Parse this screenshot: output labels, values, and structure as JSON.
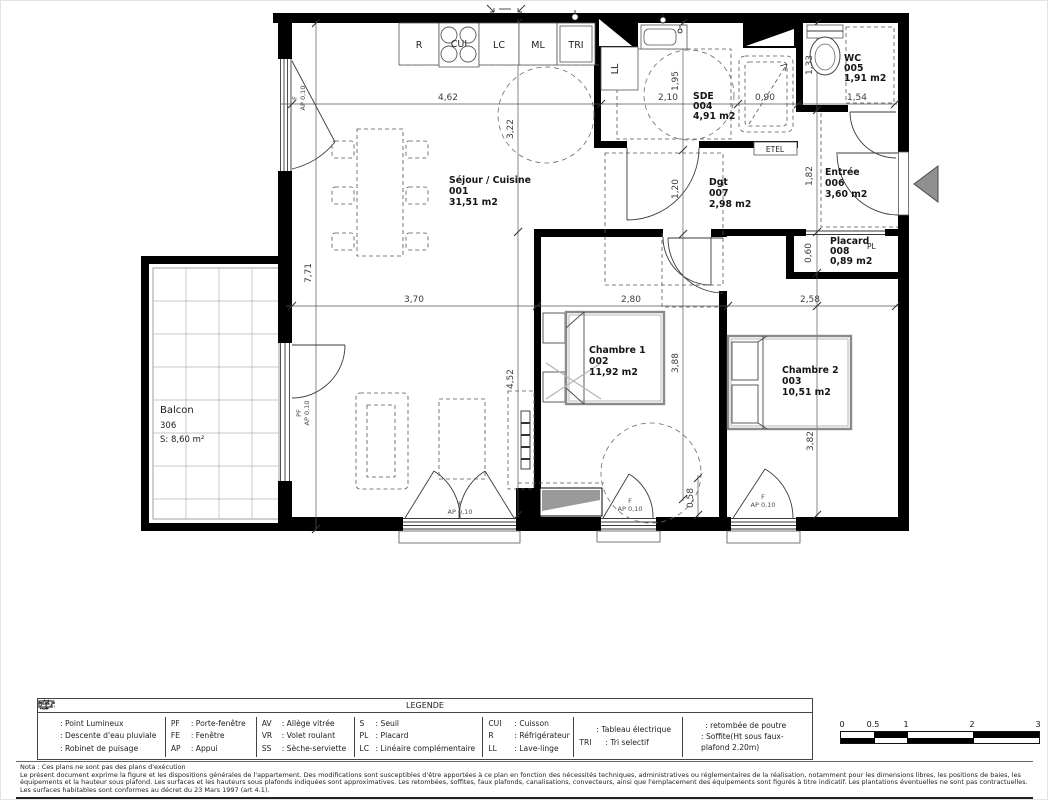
{
  "plan": {
    "rooms": {
      "sejour": {
        "name": "Séjour / Cuisine",
        "num": "001",
        "area": "31,51 m2"
      },
      "chambre1": {
        "name": "Chambre 1",
        "num": "002",
        "area": "11,92 m2"
      },
      "chambre2": {
        "name": "Chambre 2",
        "num": "003",
        "area": "10,51 m2"
      },
      "sde": {
        "name": "SDE",
        "num": "004",
        "area": "4,91 m2"
      },
      "wc": {
        "name": "WC",
        "num": "005",
        "area": "1,91 m2"
      },
      "entree": {
        "name": "Entrée",
        "num": "006",
        "area": "3,60 m2"
      },
      "dgt": {
        "name": "Dgt",
        "num": "007",
        "area": "2,98 m2"
      },
      "placard": {
        "name": "Placard",
        "num": "008",
        "area": "0,89 m2"
      },
      "balcon": {
        "name": "Balcon",
        "num": "306",
        "area": "S: 8,60 m²"
      }
    },
    "labels": {
      "r": "R",
      "cui": "CUI",
      "lc": "LC",
      "ml": "ML",
      "tri": "TRI",
      "ll": "LL",
      "etel": "ETEL",
      "pl": "PL",
      "f": "F",
      "pf": "PF",
      "ap": "AP 0,10"
    },
    "dims": {
      "sejour_top_w": "4,62",
      "kitchen_d": "3,22",
      "sde_w": "2,10",
      "sde_d": "1,95",
      "shower_w": "0,90",
      "wc_w": "1,54",
      "wc_d": "1,33",
      "dgt_d": "1,20",
      "entree_d": "1,82",
      "sejour_h": "7,71",
      "sejour_bottom_w": "3,70",
      "sejour_lower_h": "4,52",
      "ch1_w": "2,80",
      "ch1_h": "3,88",
      "ch2_w": "2,58",
      "ch2_h": "3,82",
      "placard_d": "0,60",
      "win_offset": "0,58"
    }
  },
  "legend": {
    "title": "LEGENDE",
    "symbols": [
      {
        "label": ": Point Lumineux"
      },
      {
        "label": ": Descente d'eau pluviale"
      },
      {
        "label": ": Robinet de puisage"
      }
    ],
    "openings": [
      {
        "abbr": "PF",
        "label": ": Porte-fenêtre"
      },
      {
        "abbr": "FE",
        "label": ": Fenêtre"
      },
      {
        "abbr": "AP",
        "label": ": Appui"
      }
    ],
    "glazing": [
      {
        "abbr": "AV",
        "label": ": Allège vitrée"
      },
      {
        "abbr": "VR",
        "label": ": Volet roulant"
      },
      {
        "abbr": "SS",
        "label": ": Sèche-serviette"
      }
    ],
    "misc": [
      {
        "abbr": "S",
        "label": ": Seuil"
      },
      {
        "abbr": "PL",
        "label": ": Placard"
      },
      {
        "abbr": "LC",
        "label": ": Linéaire complémentaire"
      }
    ],
    "kitchen": [
      {
        "abbr": "CUI",
        "label": ": Cuisson"
      },
      {
        "abbr": "R",
        "label": ": Réfrigérateur"
      },
      {
        "abbr": "LL",
        "label": ": Lave-linge"
      }
    ],
    "electric": [
      {
        "label": ": Tableau électrique"
      },
      {
        "abbr": "TRI",
        "label": ": Tri selectif"
      }
    ],
    "ceiling": [
      {
        "label": ": retombée de poutre"
      },
      {
        "label": ": Soffite(Ht sous faux-plafond 2.20m)"
      }
    ]
  },
  "notes": {
    "l1": "Nota : Ces plans ne sont pas des plans d'exécution",
    "l2": "Le présent document exprime la figure et les dispositions générales de l'appartement. Des modifications sont susceptibles d'être apportées à ce plan en fonction des nécessités techniques, administratives ou réglementaires de la réalisation, notamment pour les dimensions libres, les positions de baies, les",
    "l3": "équipements et la hauteur sous plafond. Les surfaces et les hauteurs sous plafonds indiquées sont approximatives. Les retombées, soffites, faux plafonds, canalisations, convecteurs, ainsi que l'emplacement des équipements sont figurés à titre indicatif. Les plantations éventuelles ne sont pas contractuelles.",
    "l4": "Les surfaces habitables sont conformes au décret du 23 Mars 1997 (art 4.1)."
  },
  "scale": {
    "t0": "0",
    "t1": "0.5",
    "t2": "1",
    "t3": "2",
    "t4": "3"
  }
}
